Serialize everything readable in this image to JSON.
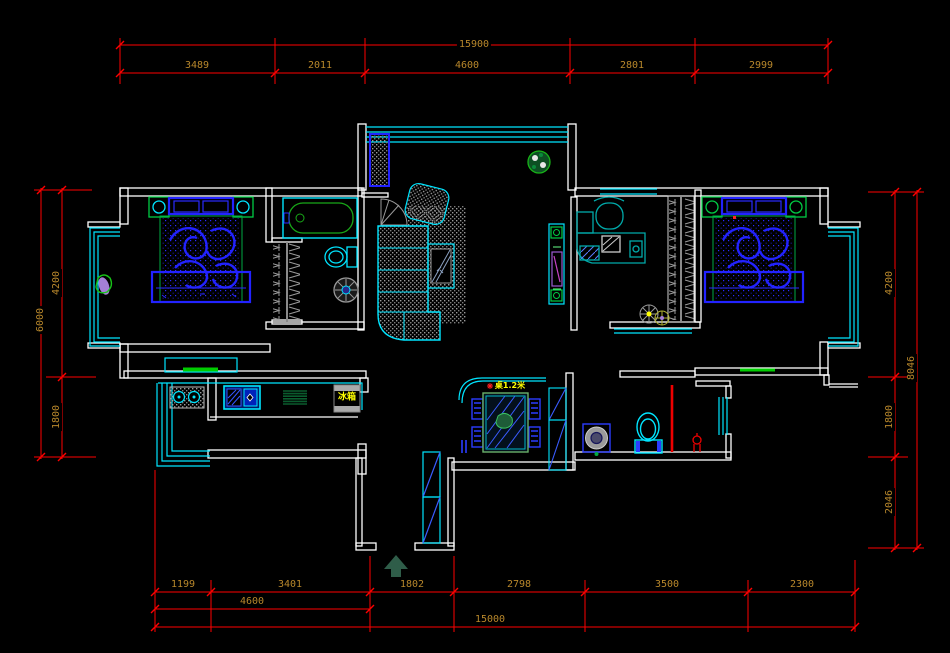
{
  "drawing": {
    "type": "residential floor plan (CAD)",
    "background": "#000000",
    "colors": {
      "wall": "#ffffff",
      "window_fixture": "#00e5ff",
      "furniture_blue": "#2222ff",
      "accent_green": "#00cc44",
      "dark_green_hatch": "#0a5c2e",
      "hatch_gray": "#9a9a9a",
      "dimension_line_red": "#ff0000",
      "dimension_text": "#b8872b",
      "label_yellow": "#ffff00",
      "plant_purple": "#a57fd6"
    },
    "annotations": {
      "fridge_label": "冰箱",
      "dining_table_label": "桌1.2米"
    },
    "dimensions": {
      "top": {
        "overall": "15900",
        "segments": [
          "3489",
          "2011",
          "4600",
          "2801",
          "2999"
        ]
      },
      "left": {
        "overall": "6000",
        "segments": [
          "4200",
          "1800"
        ]
      },
      "right": {
        "overall": "8046",
        "segments": [
          "4200",
          "1800",
          "2046"
        ]
      },
      "bottom": {
        "segments": [
          "1199",
          "3401",
          "1802",
          "2798",
          "3500",
          "2300"
        ],
        "subtotal": "4600",
        "overall": "15000"
      }
    }
  }
}
